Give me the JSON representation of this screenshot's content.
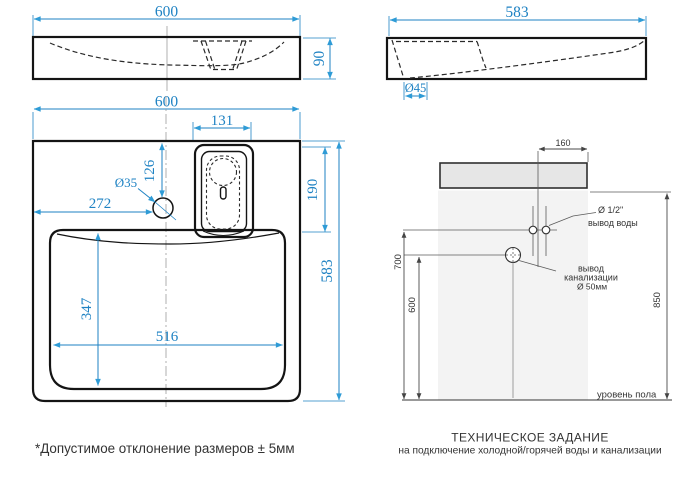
{
  "front_view": {
    "width": "600",
    "height": "90"
  },
  "side_view": {
    "width": "583",
    "drain_dia": "Ø45"
  },
  "plan_view": {
    "width": "600",
    "box_width": "131",
    "faucet_from_top": "126",
    "faucet_dia": "Ø35",
    "faucet_from_left": "272",
    "box_depth": "190",
    "depth": "583",
    "bowl_depth": "347",
    "bowl_width": "516"
  },
  "install": {
    "offset_right": "160",
    "water_height": "700",
    "drain_height": "600",
    "mount_height": "850",
    "water_dia": "Ø 1/2\"",
    "water_outlet": "вывод воды",
    "drain_outlet_line1": "вывод",
    "drain_outlet_line2": "канализации",
    "drain_dia": "Ø 50мм",
    "floor_level": "уровень пола"
  },
  "title_block": {
    "title": "ТЕХНИЧЕСКОЕ ЗАДАНИЕ",
    "subtitle": "на подключение холодной/горячей воды и канализации"
  },
  "footnote": "*Допустимое отклонение размеров ± 5мм",
  "colors": {
    "dimension_blue": "#1e82c3",
    "drawing_black": "#141414",
    "wall_gray": "#f3f3f3",
    "fixture_gray": "#e6e6e6"
  }
}
